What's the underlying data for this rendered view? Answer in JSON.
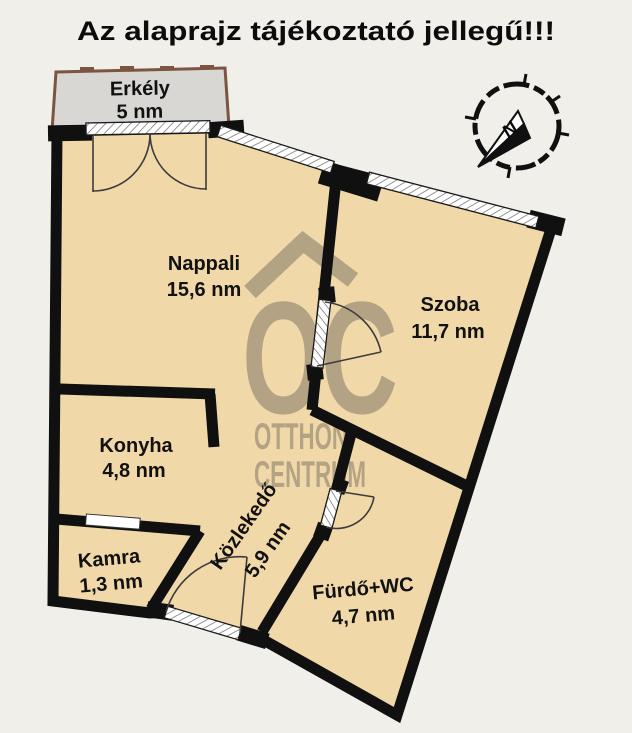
{
  "title": "Az alaprajz tájékoztató jellegű!!!",
  "colors": {
    "background": "#f1efe9",
    "floor": "#f0d8a8",
    "wall": "#101010",
    "balcony_fill": "#d8d7d4",
    "balcony_border": "#7d5440",
    "watermark": "#a4967c"
  },
  "compass": {
    "north_label": "N"
  },
  "watermark": {
    "logo": "OC",
    "line1": "OTTHON",
    "line2": "CENTRUM"
  },
  "rooms": {
    "erkely": {
      "name": "Erkély",
      "area": "5 nm"
    },
    "nappali": {
      "name": "Nappali",
      "area": "15,6 nm"
    },
    "szoba": {
      "name": "Szoba",
      "area": "11,7 nm"
    },
    "konyha": {
      "name": "Konyha",
      "area": "4,8 nm"
    },
    "kamra": {
      "name": "Kamra",
      "area": "1,3 nm"
    },
    "kozlekedo": {
      "name": "Közlekedő",
      "area": "5,9 nm"
    },
    "furdo": {
      "name": "Fürdő+WC",
      "area": "4,7 nm"
    }
  }
}
